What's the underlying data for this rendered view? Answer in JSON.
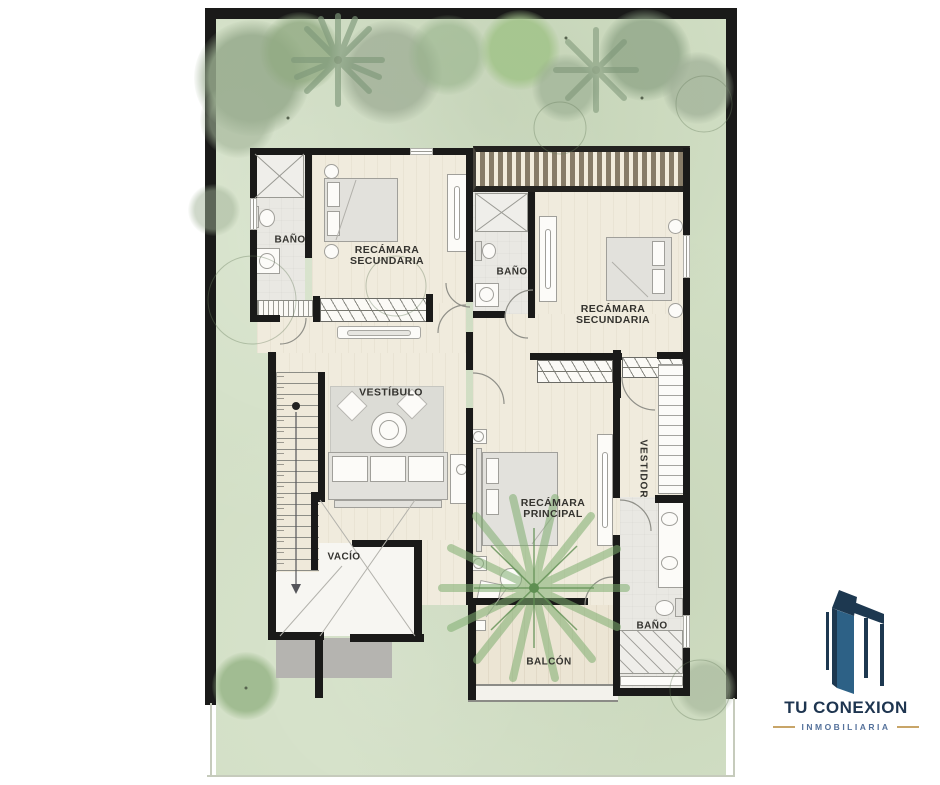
{
  "branding": {
    "name": "TU CONEXION",
    "tagline": "INMOBILIARIA",
    "name_color": "#1e3550",
    "tagline_color": "#54719b",
    "accent_line_color": "#c8a568",
    "building_navy": "#1d3850",
    "building_steel": "#2d6186"
  },
  "floorplan": {
    "rooms": [
      {
        "id": "bano-1",
        "lines": [
          "BAÑO"
        ]
      },
      {
        "id": "recamara-secundaria-1",
        "lines": [
          "RECÁMARA",
          "SECUNDARIA"
        ]
      },
      {
        "id": "bano-2",
        "lines": [
          "BAÑO"
        ]
      },
      {
        "id": "recamara-secundaria-2",
        "lines": [
          "RECÁMARA",
          "SECUNDARIA"
        ]
      },
      {
        "id": "vestibulo",
        "lines": [
          "VESTÍBULO"
        ]
      },
      {
        "id": "recamara-principal",
        "lines": [
          "RECÁMARA",
          "PRINCIPAL"
        ]
      },
      {
        "id": "vestidor",
        "lines": [
          "VESTIDOR"
        ]
      },
      {
        "id": "vacio",
        "lines": [
          "VACÍO"
        ]
      },
      {
        "id": "bano-3",
        "lines": [
          "BAÑO"
        ]
      },
      {
        "id": "balcon",
        "lines": [
          "BALCÓN"
        ]
      }
    ]
  },
  "palette": {
    "lawn": "#d2dfc5",
    "wall": "#1a1a19",
    "wood_floor": "#f0ebdd",
    "tile_floor": "#e9e8e3",
    "pergola_slat": "#877c68",
    "roof_slab_gray": "#b5b4b0",
    "label_text": "#34332f"
  },
  "icons": {
    "bed": "rect+pillows shape",
    "toilet": "tank+bowl shape",
    "sink": "square+circle shape",
    "shower": "x-crossed square",
    "sofa": "cushioned rect",
    "coffee-table": "double circle",
    "stairs": "treaded strip with down arrow",
    "palm-tree": "radiating frond lines",
    "tree": "soft green blob",
    "closet": "rect with rod pill",
    "wardrobe-rod": "diagonal hatch band",
    "logo-building": "two skyscraper polygons"
  }
}
